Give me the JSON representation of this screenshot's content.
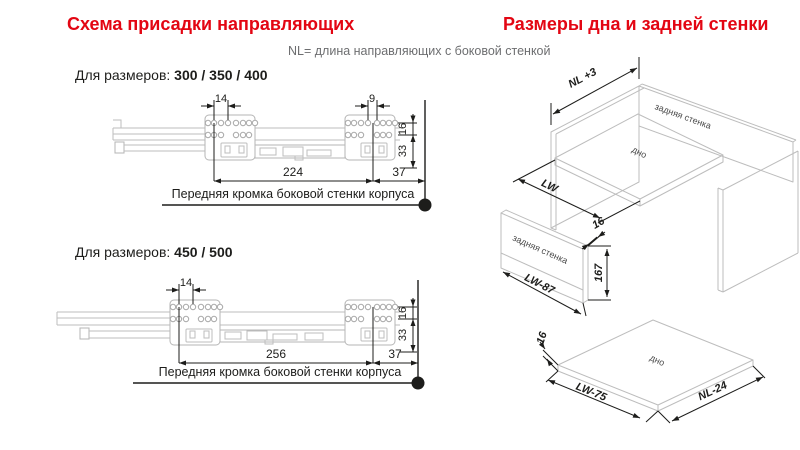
{
  "header": {
    "left_title": "Схема присадки направляющих",
    "right_title": "Размеры дна и задней стенки",
    "nl_note": "NL= длина направляющих с боковой стенкой"
  },
  "colors": {
    "accent_red": "#e30613",
    "note_grey": "#6d6e70",
    "line_dark": "#1d1d1b",
    "line_light": "#bdbdbd"
  },
  "diagram_300_350_400": {
    "label_prefix": "Для размеров: ",
    "label_sizes": "300 / 350 / 400",
    "dim_front_hole_pitch": "14",
    "dim_rear_hole_pitch": "9",
    "dim_hole_rows_gap": "16",
    "dim_rows_to_bottom": "33",
    "dim_hole_span": "224",
    "dim_front_offset": "37",
    "caption": "Передняя кромка боковой стенки корпуса"
  },
  "diagram_450_500": {
    "label_prefix": "Для размеров: ",
    "label_sizes": "450 / 500",
    "dim_front_hole_pitch": "14",
    "dim_hole_rows_gap": "16",
    "dim_rows_to_bottom": "33",
    "dim_hole_span": "256",
    "dim_front_offset": "37",
    "caption": "Передняя кромка боковой стенки корпуса"
  },
  "cabinet_iso": {
    "dim_depth": "NL +3",
    "dim_width": "LW",
    "back_wall_label": "задняя стенка",
    "bottom_label": "дно"
  },
  "back_wall_panel": {
    "label": "задняя стенка",
    "dim_width": "LW-87",
    "dim_height": "167",
    "dim_thickness": "16"
  },
  "bottom_panel": {
    "label": "дно",
    "dim_width": "LW-75",
    "dim_depth": "NL-24",
    "dim_thickness": "16"
  }
}
